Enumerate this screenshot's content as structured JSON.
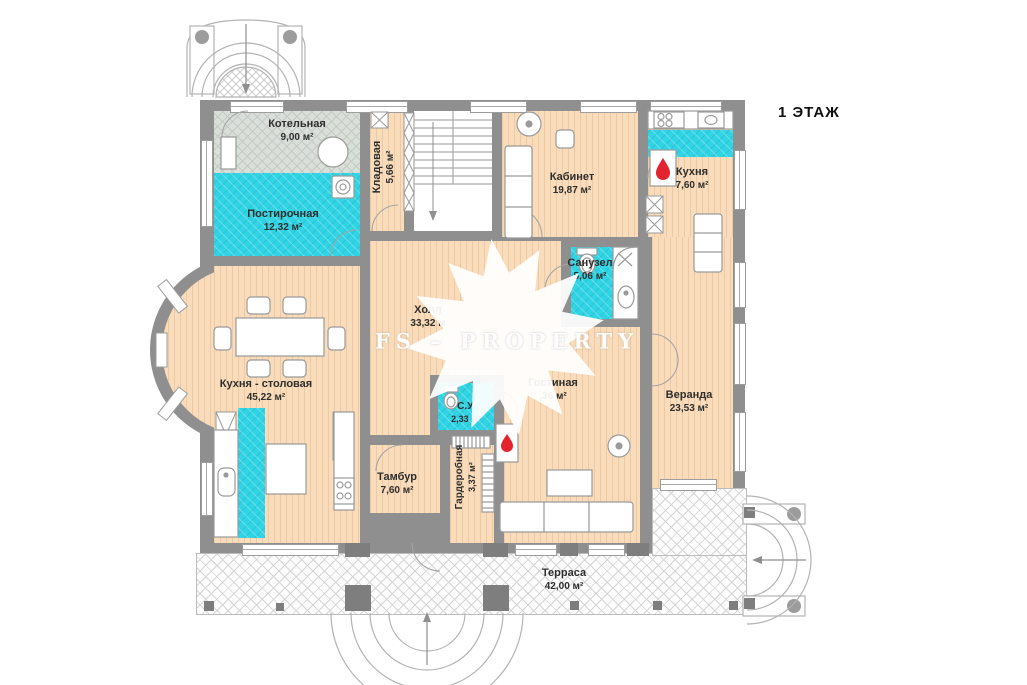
{
  "title": "1 ЭТАЖ",
  "watermark": "FS – PROPERTY",
  "rooms": {
    "boiler": {
      "name": "Котельная",
      "area": "9,00 м²"
    },
    "laundry": {
      "name": "Постирочная",
      "area": "12,32 м²"
    },
    "pantry": {
      "name": "Кладовая",
      "area": "5,66 м²"
    },
    "office": {
      "name": "Кабинет",
      "area": "19,87 м²"
    },
    "kitchen": {
      "name": "Кухня",
      "area": "7,60 м²"
    },
    "bathroom": {
      "name": "Санузел",
      "area": "5,06 м²"
    },
    "hall": {
      "name": "Холл",
      "area": "33,32 м"
    },
    "kitchen_dining": {
      "name": "Кухня - столовая",
      "area": "45,22 м²"
    },
    "living": {
      "name": "Гостиная",
      "area": ",36 м²"
    },
    "veranda": {
      "name": "Веранда",
      "area": "23,53 м²"
    },
    "wc": {
      "name": "С.У.",
      "area": "2,33 м²"
    },
    "vestibule": {
      "name": "Тамбур",
      "area": "7,60 м²"
    },
    "wardrobe": {
      "name": "Гардеробная",
      "area": "3,37 м²"
    },
    "terrace": {
      "name": "Терраса",
      "area": "42,00 м²"
    }
  },
  "colors": {
    "wall": "#8f8f8f",
    "wood_floor": "#f8dcbb",
    "wet_tile": "#30d4e4",
    "boiler_floor": "#dadfda",
    "accent_red": "#e3232e",
    "label_text": "#2e2e2e"
  }
}
